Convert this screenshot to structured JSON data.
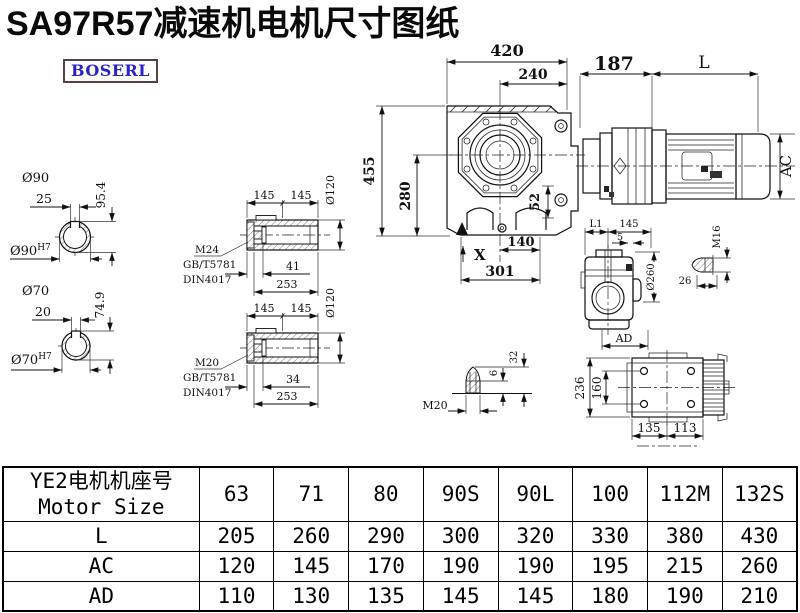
{
  "page": {
    "title": "SA97R57减速机电机尺寸图纸",
    "brand": "BOSERL"
  },
  "dims": {
    "front": {
      "w420": "420",
      "w240": "240",
      "h455": "455",
      "h280": "280",
      "d52": "52",
      "x_mark": "X",
      "w140": "140",
      "w301": "301"
    },
    "motor": {
      "w187": "187",
      "l": "L",
      "ac": "AC"
    },
    "shaft_a": {
      "dia": "Ø90",
      "key": "25",
      "depth": "95.4",
      "bore": "Ø90",
      "fit": "H7"
    },
    "shaft_b": {
      "dia": "Ø70",
      "key": "20",
      "depth": "74.9",
      "bore": "Ø70",
      "fit": "H7"
    },
    "hollow_a": {
      "seg1": "145",
      "seg2": "145",
      "dia": "Ø120",
      "thread": "M24",
      "std1": "GB/T5781",
      "std2": "DIN4017",
      "bolt": "41",
      "len": "253"
    },
    "hollow_b": {
      "seg1": "145",
      "seg2": "145",
      "dia": "Ø120",
      "thread": "M20",
      "std1": "GB/T5781",
      "std2": "DIN4017",
      "bolt": "34",
      "len": "253"
    },
    "side": {
      "l1": "L1",
      "w145": "145",
      "w5": "5",
      "dia": "Ø260",
      "ad": "AD"
    },
    "m16": {
      "thread": "M16",
      "len": "26"
    },
    "m20": {
      "thread": "M20",
      "h6": "6",
      "h32": "32"
    },
    "top": {
      "h236": "236",
      "h160": "160",
      "w135": "135",
      "w113": "113"
    }
  },
  "table": {
    "header_line1": "YE2电机机座号",
    "header_line2": "Motor Size",
    "sizes": [
      "63",
      "71",
      "80",
      "90S",
      "90L",
      "100",
      "112M",
      "132S"
    ],
    "rows": [
      {
        "label": "L",
        "values": [
          "205",
          "260",
          "290",
          "300",
          "320",
          "330",
          "380",
          "430"
        ]
      },
      {
        "label": "AC",
        "values": [
          "120",
          "145",
          "170",
          "190",
          "190",
          "195",
          "215",
          "260"
        ]
      },
      {
        "label": "AD",
        "values": [
          "110",
          "130",
          "135",
          "145",
          "145",
          "180",
          "190",
          "210"
        ]
      }
    ]
  }
}
